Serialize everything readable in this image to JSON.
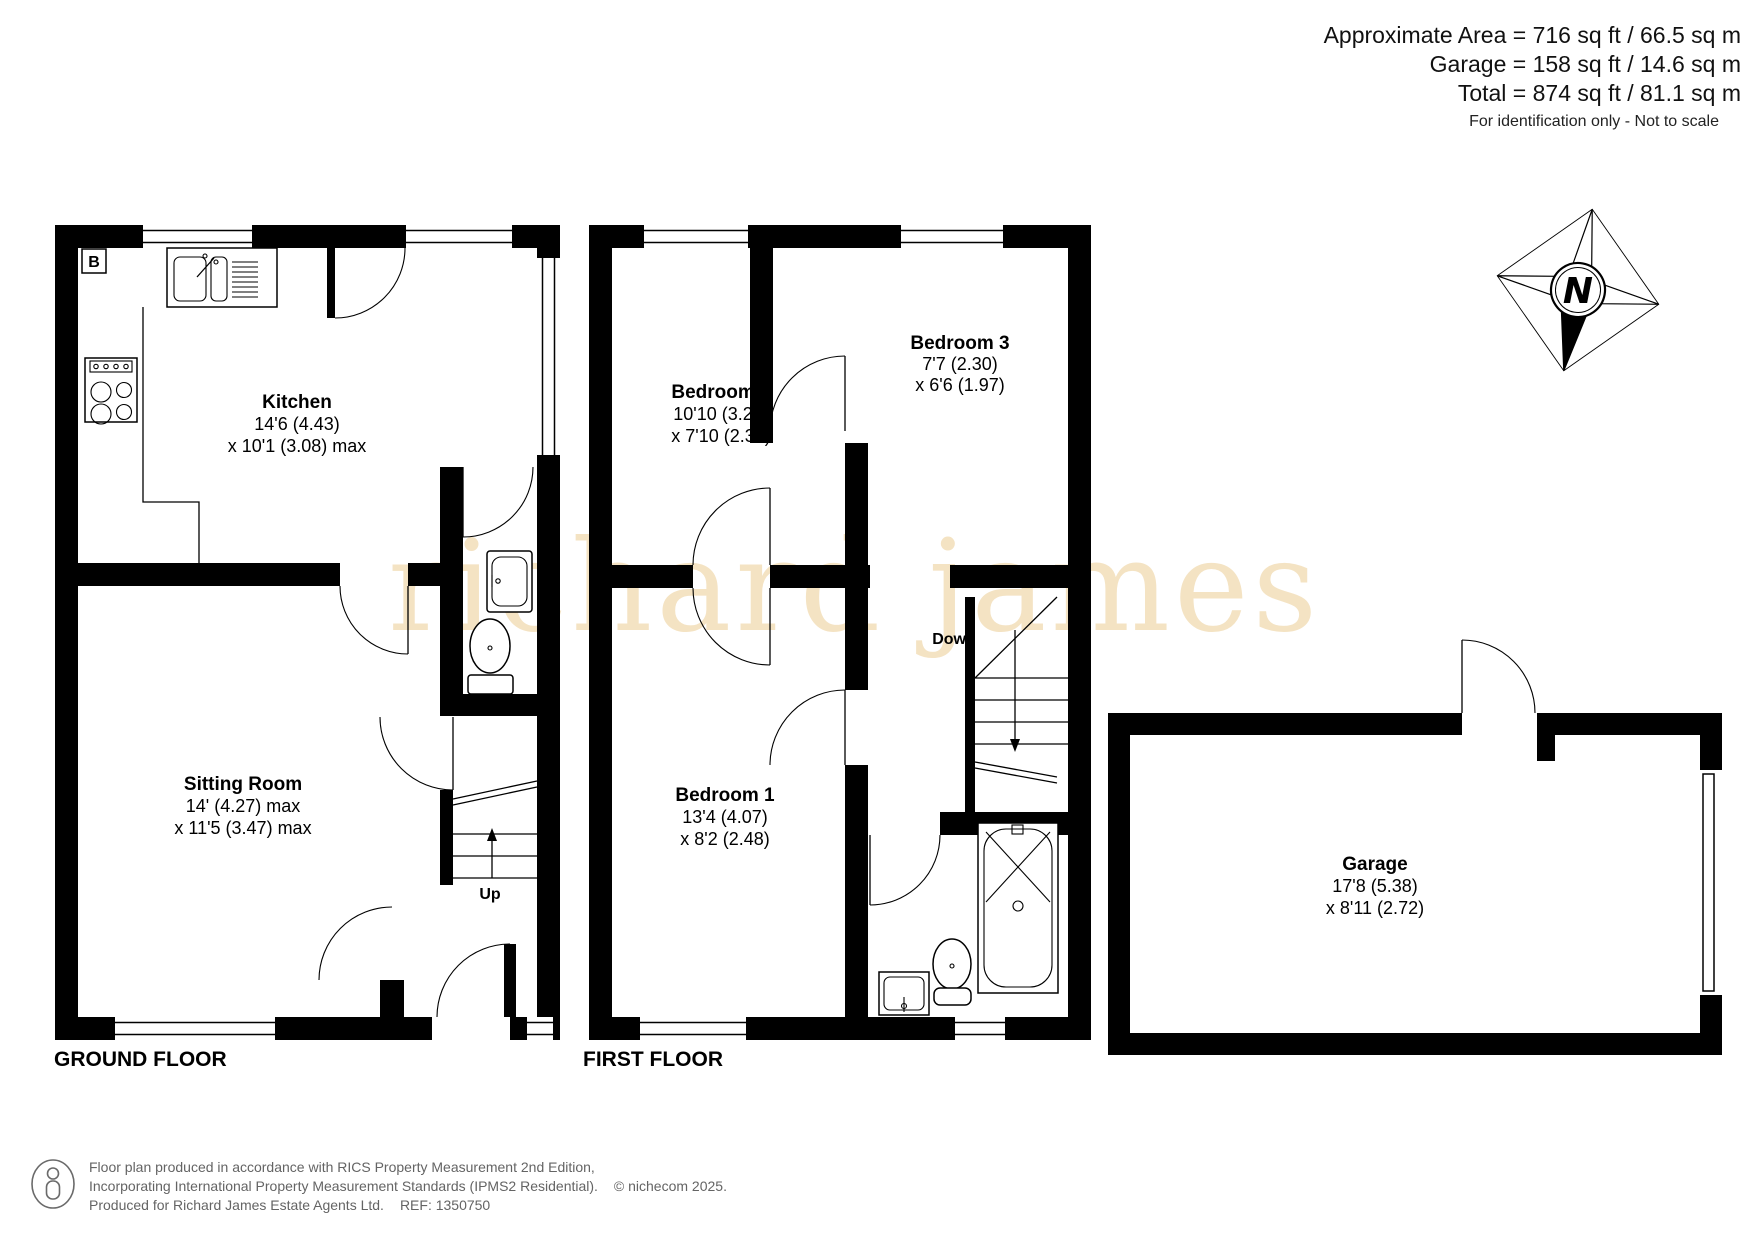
{
  "header": {
    "area_line": "Approximate Area = 716 sq ft / 66.5 sq m",
    "garage_line": "Garage = 158 sq ft / 14.6 sq m",
    "total_line": "Total = 874 sq ft / 81.1 sq m",
    "disclaimer": "For identification only - Not to scale"
  },
  "watermark": {
    "text": "richard james",
    "color": "#f4e3c3"
  },
  "compass": {
    "label": "N"
  },
  "ground_floor": {
    "label": "GROUND FLOOR",
    "boiler": "B",
    "stairs": "Up",
    "kitchen": {
      "name": "Kitchen",
      "dim1": "14'6 (4.43)",
      "dim2": "x 10'1 (3.08) max"
    },
    "sitting_room": {
      "name": "Sitting Room",
      "dim1": "14' (4.27) max",
      "dim2": "x 11'5 (3.47) max"
    }
  },
  "first_floor": {
    "label": "FIRST FLOOR",
    "stairs": "Down",
    "bedroom2": {
      "name": "Bedroom 2",
      "dim1": "10'10 (3.29)",
      "dim2": "x 7'10 (2.38)"
    },
    "bedroom3": {
      "name": "Bedroom 3",
      "dim1": "7'7 (2.30)",
      "dim2": "x 6'6 (1.97)"
    },
    "bedroom1": {
      "name": "Bedroom 1",
      "dim1": "13'4 (4.07)",
      "dim2": "x 8'2 (2.48)"
    }
  },
  "garage": {
    "room": {
      "name": "Garage",
      "dim1": "17'8 (5.38)",
      "dim2": "x 8'11 (2.72)"
    }
  },
  "footer": {
    "line1": "Floor plan produced in accordance with RICS Property Measurement 2nd Edition,",
    "line2": "Incorporating International Property Measurement Standards (IPMS2 Residential).",
    "copyright": "© nichecom 2025.",
    "line3": "Produced for Richard James Estate Agents Ltd.",
    "ref": "REF: 1350750"
  }
}
